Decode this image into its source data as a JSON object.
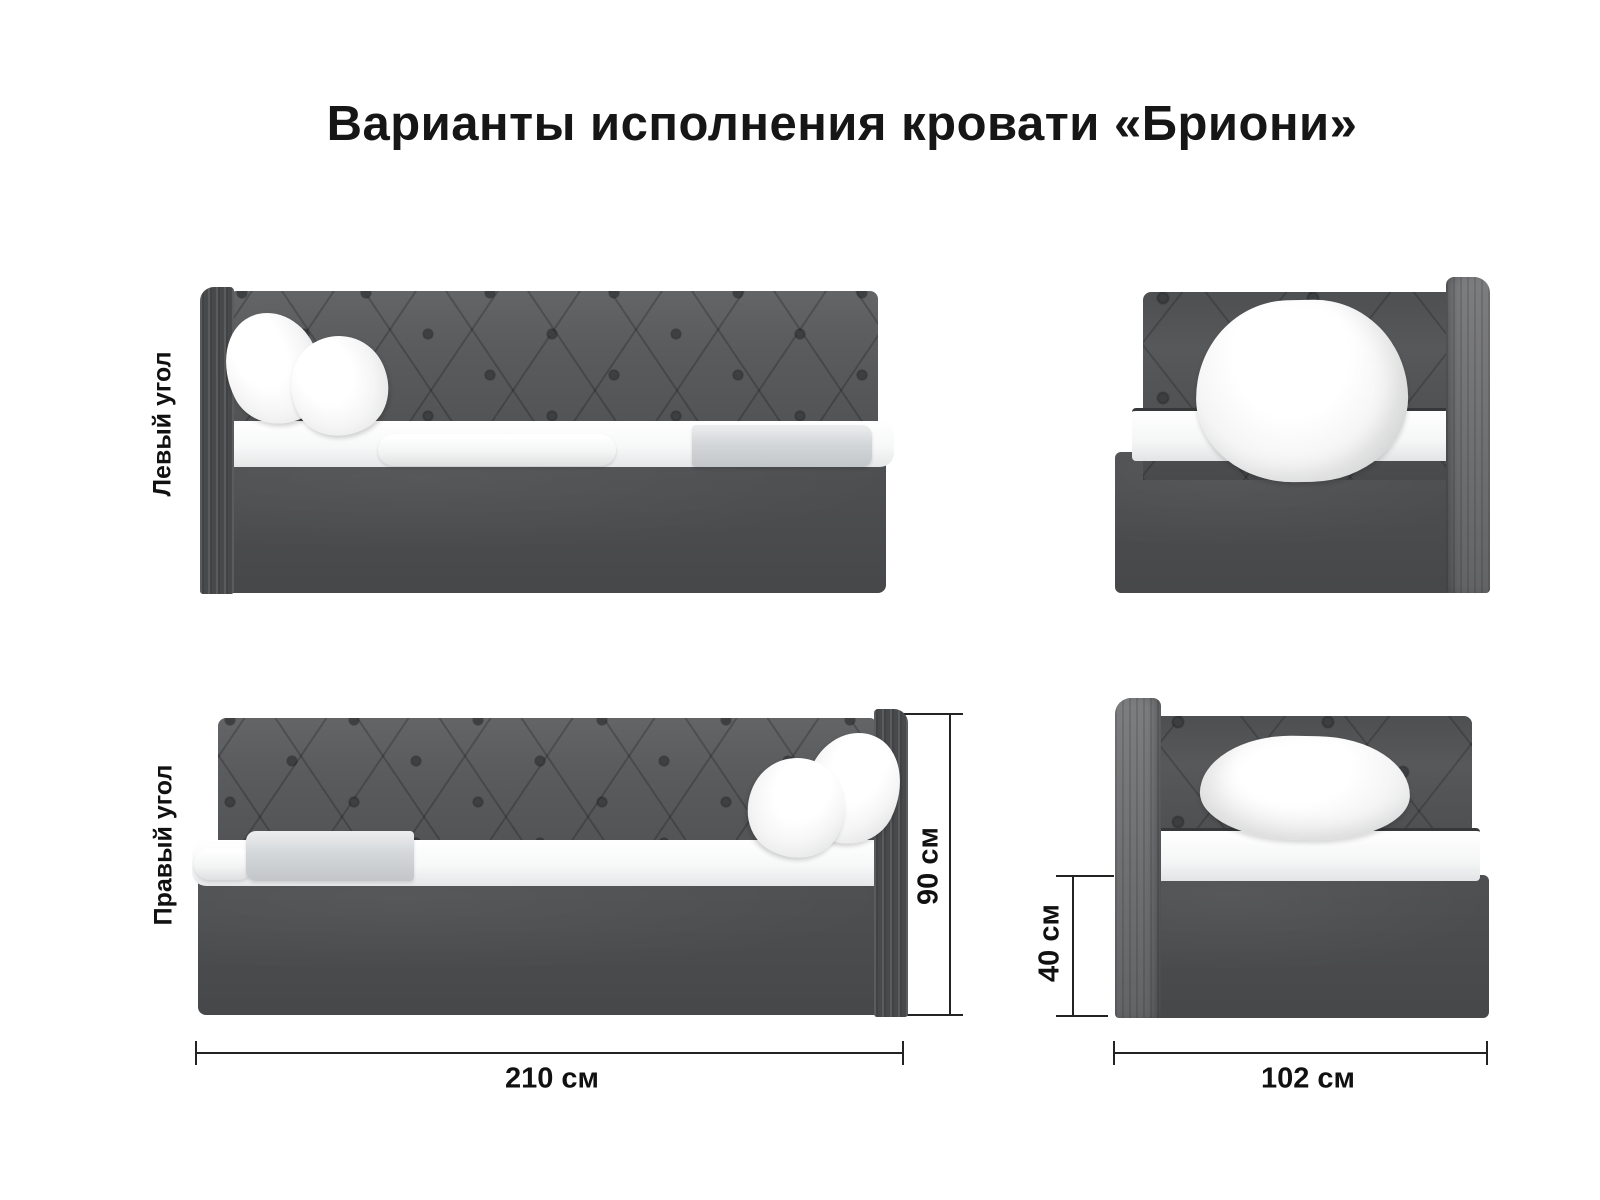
{
  "title": "Варианты исполнения кровати «Бриони»",
  "views": {
    "left_corner_label": "Левый угол",
    "right_corner_label": "Правый угол"
  },
  "dimensions": {
    "length": "210 см",
    "total_height": "90 см",
    "base_height": "40 см",
    "width": "102 см"
  },
  "colors": {
    "background": "#ffffff",
    "fabric": "#5a5b5d",
    "fabric_shadow": "#4b4c4e",
    "side_panel_edge": "#48494b",
    "side_panel_front": "#6e6f71",
    "base": "#535456",
    "tuft_button": "#3e3f41",
    "mattress": "#f7f8f8",
    "mattress_piping": "#37383a",
    "blanket": "#d4d7d9",
    "text": "#161616",
    "dimension_line": "#232323"
  }
}
